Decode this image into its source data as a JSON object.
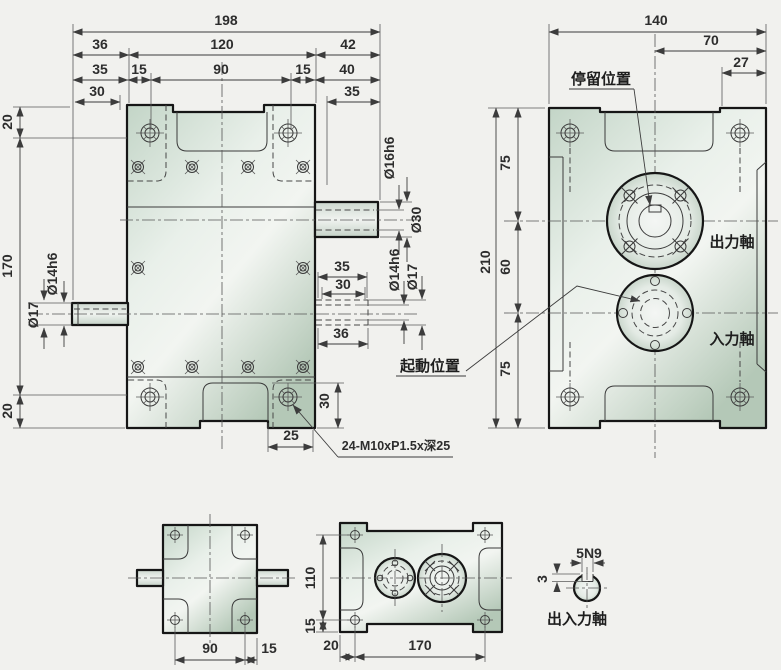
{
  "front_view": {
    "dims": [
      "198",
      "36",
      "120",
      "42",
      "35",
      "15",
      "90",
      "15",
      "40",
      "30",
      "35",
      "20",
      "170",
      "20",
      "Ø14h6",
      "Ø17",
      "Ø16h6",
      "Ø30",
      "35",
      "30",
      "Ø14h6",
      "Ø17",
      "36",
      "30",
      "25"
    ],
    "thread_note": "24-M10xP1.5x深25"
  },
  "side_view": {
    "dims": [
      "140",
      "70",
      "27",
      "75",
      "210",
      "60",
      "75"
    ],
    "labels": {
      "stop_position": "停留位置",
      "start_position": "起動位置",
      "output_shaft": "出力軸",
      "input_shaft": "入力軸"
    }
  },
  "bottom_front": {
    "dims": [
      "90",
      "15"
    ]
  },
  "bottom_top": {
    "dims": [
      "110",
      "15",
      "20",
      "170"
    ]
  },
  "shaft_section": {
    "key_width": "5N9",
    "key_depth": "3",
    "label": "出入力軸"
  },
  "colors": {
    "background": "#f1f1ee",
    "body_fill": "#d9e5db",
    "line": "#161616"
  }
}
